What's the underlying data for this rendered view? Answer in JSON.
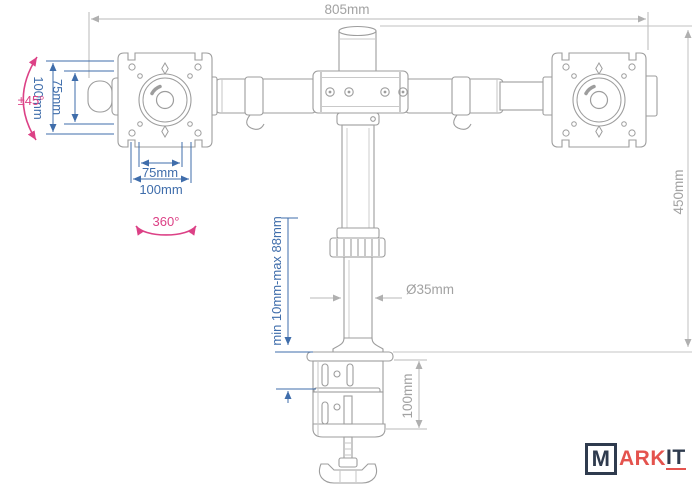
{
  "dimensions": {
    "bar_length": "805mm",
    "overall_height": "450mm",
    "vesa_plate_height": "100mm",
    "vesa_vertical_spacing": "75mm",
    "vesa_horizontal_spacing": "75mm",
    "vesa_plate_width": "100mm",
    "pole_diameter": "Ø35mm",
    "clamp_range": "min 10mm-max 88mm",
    "clamp_body_height": "100mm"
  },
  "angles": {
    "tilt": "±45°",
    "rotation": "360°"
  },
  "logo": {
    "m": "M",
    "ark": "ARK",
    "it": "IT"
  },
  "colors": {
    "dimension_blue": "#3f6dab",
    "dimension_gray": "#a2a2a2",
    "drawing_gray": "#9d9d9d",
    "accent_pink": "#dc4186",
    "logo_navy": "#2f3b4e",
    "logo_red": "#e4534e"
  }
}
